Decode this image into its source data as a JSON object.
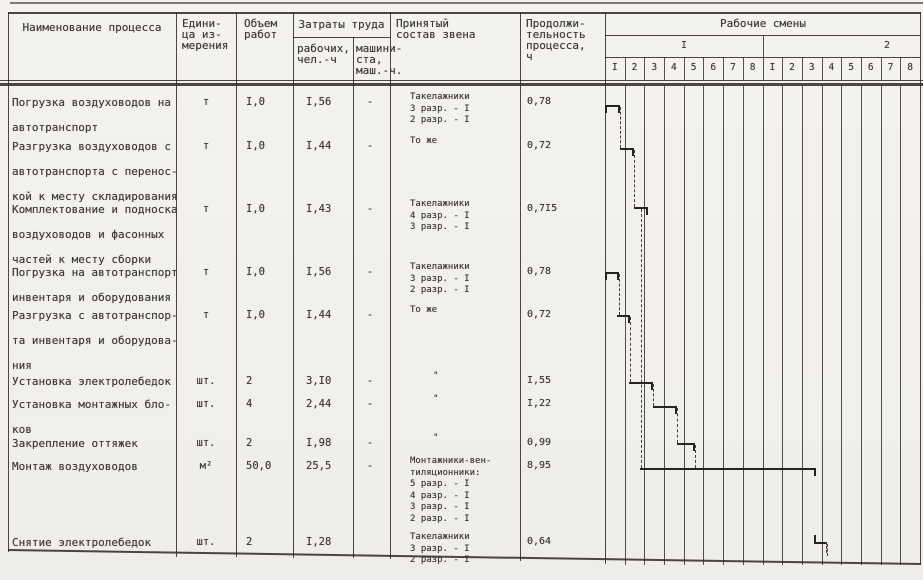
{
  "header": {
    "process": "Наименование процесса",
    "unit": "Едини-\nца из-\nмерения",
    "volume": "Объем\nработ",
    "labor": "Затраты труда",
    "labor_workers": "рабочих,\nчел.-ч",
    "labor_machine": "машини-\nста,\nмаш.-ч.",
    "crew": "Принятый\nсостав звена",
    "duration": "Продолжи-\nтельность\nпроцесса,\nч",
    "shifts_title": "Рабочие смены",
    "shift1_label": "I",
    "shift2_label": "2",
    "hours1": [
      "I",
      "2",
      "3",
      "4",
      "5",
      "6",
      "7",
      "8"
    ],
    "hours2": [
      "I",
      "2",
      "3",
      "4",
      "5",
      "6",
      "7",
      "8"
    ]
  },
  "rows": [
    {
      "name": "Погрузка воздуховодов на\nавтотранспорт",
      "unit": "т",
      "volume": "I,0",
      "labor_workers": "I,56",
      "labor_machine": "-",
      "crew": "Такелажники\n3 разр. - I\n2 разр. - I",
      "duration": "0,78"
    },
    {
      "name": "Разгрузка воздуховодов с\nавтотранспорта с перенос-\nкой к месту складирования",
      "unit": "т",
      "volume": "I,0",
      "labor_workers": "I,44",
      "labor_machine": "-",
      "crew": "То же",
      "duration": "0,72"
    },
    {
      "name": "Комплектование и подноска\nвоздуховодов и фасонных\nчастей к месту сборки",
      "unit": "т",
      "volume": "I,0",
      "labor_workers": "I,43",
      "labor_machine": "-",
      "crew": "Такелажники\n4 разр. - I\n3 разр. - I",
      "duration": "0,7I5"
    },
    {
      "name": "Погрузка на автотранспорт\nинвентаря и оборудования",
      "unit": "т",
      "volume": "I,0",
      "labor_workers": "I,56",
      "labor_machine": "-",
      "crew": "Такелажники\n3 разр. - I\n2 разр. - I",
      "duration": "0,78"
    },
    {
      "name": "Разгрузка с автотранспор-\nта инвентаря и оборудова-\nния",
      "unit": "т",
      "volume": "I,0",
      "labor_workers": "I,44",
      "labor_machine": "-",
      "crew": "То же",
      "duration": "0,72"
    },
    {
      "name": "Установка электролебедок",
      "unit": "шт.",
      "volume": "2",
      "labor_workers": "3,I0",
      "labor_machine": "-",
      "crew": "\"",
      "duration": "I,55"
    },
    {
      "name": "Установка монтажных бло-\nков",
      "unit": "шт.",
      "volume": "4",
      "labor_workers": "2,44",
      "labor_machine": "-",
      "crew": "\"",
      "duration": "I,22"
    },
    {
      "name": "Закрепление оттяжек",
      "unit": "шт.",
      "volume": "2",
      "labor_workers": "I,98",
      "labor_machine": "-",
      "crew": "\"",
      "duration": "0,99"
    },
    {
      "name": "Монтаж воздуховодов",
      "unit": "м²",
      "volume": "50,0",
      "labor_workers": "25,5",
      "labor_machine": "-",
      "crew": "Монтажники-вен-\nтиляционники:\n5 разр. - I\n4 разр. - I\n3 разр. - I\n2 разр. - I",
      "duration": "8,95"
    },
    {
      "name": "Снятие электролебедок",
      "unit": "шт.",
      "volume": "2",
      "labor_workers": "I,28",
      "labor_machine": "",
      "crew": "Такелажники\n3 разр. - I\n2 разр. - I",
      "duration": "0,64"
    }
  ],
  "gantt": {
    "hours_per_shift": 8,
    "shift_count": 2,
    "bars": [
      {
        "row": 0,
        "start": 0,
        "end": 0.78,
        "tick_start": "down"
      },
      {
        "row": 1,
        "start": 0.76,
        "end": 1.48
      },
      {
        "row": 2,
        "start": 1.48,
        "end": 2.2
      },
      {
        "row": 3,
        "start": 0,
        "end": 0.73,
        "tick_start": "down"
      },
      {
        "row": 4,
        "start": 0.62,
        "end": 1.28
      },
      {
        "row": 5,
        "start": 1.22,
        "end": 2.44
      },
      {
        "row": 6,
        "start": 2.44,
        "end": 3.66
      },
      {
        "row": 7,
        "start": 3.66,
        "end": 4.58
      },
      {
        "row": 8,
        "start": 1.78,
        "end": 10.72
      },
      {
        "row": 9,
        "start": 10.6,
        "end": 11.28,
        "tick_start": "up",
        "tick_end": "dashed"
      }
    ],
    "connectors": [
      {
        "x": 0.76,
        "from": 0,
        "to": 1
      },
      {
        "x": 1.48,
        "from": 1,
        "to": 2
      },
      {
        "x": 1.85,
        "from": 2,
        "to": 8
      },
      {
        "x": 0.73,
        "from": 3,
        "to": 4
      },
      {
        "x": 1.28,
        "from": 4,
        "to": 5
      },
      {
        "x": 2.44,
        "from": 5,
        "to": 6
      },
      {
        "x": 3.66,
        "from": 6,
        "to": 7
      },
      {
        "x": 4.58,
        "from": 7,
        "to": 8
      },
      {
        "x": 11.28,
        "from": 9,
        "to": null
      }
    ]
  }
}
